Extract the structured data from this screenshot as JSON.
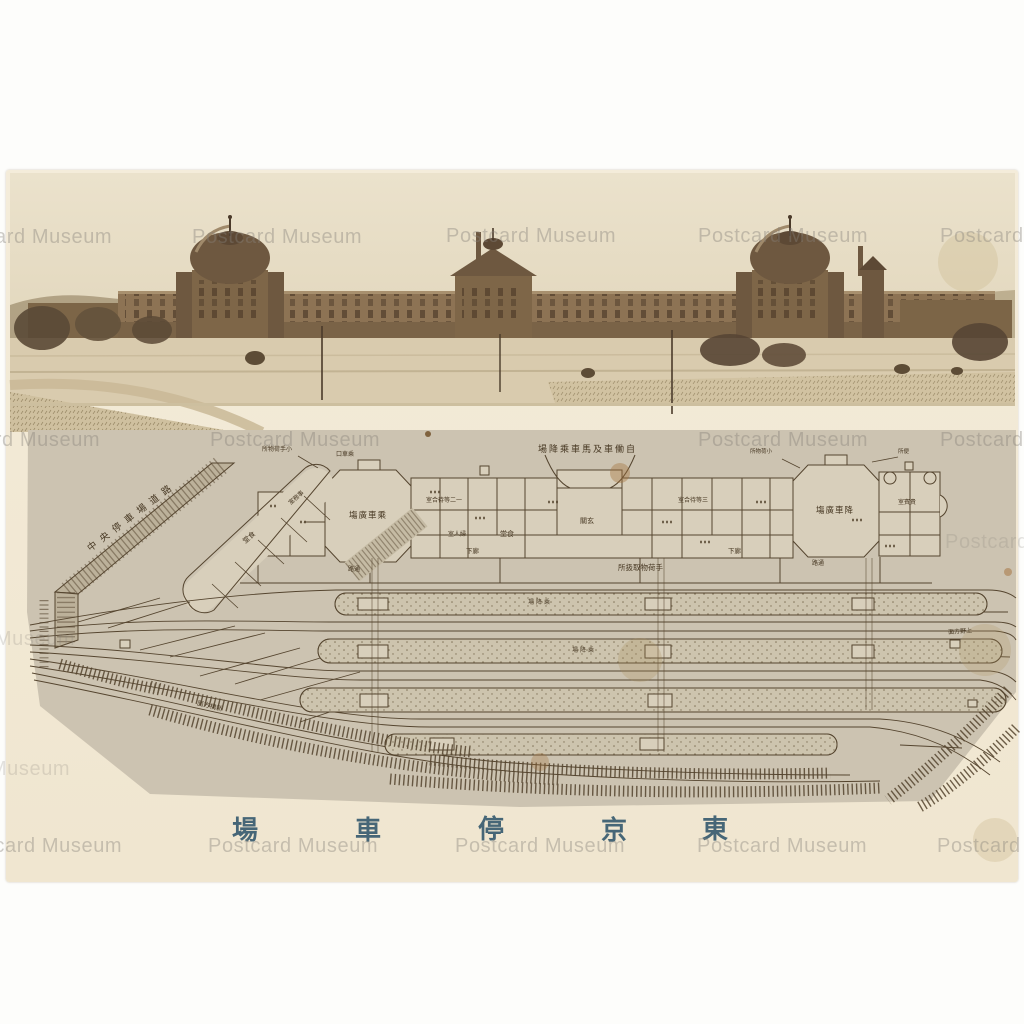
{
  "postcard": {
    "card_color": "#f2e9d5",
    "title": {
      "display_chars": [
        "場",
        "車",
        "停",
        "京",
        "東"
      ],
      "reads_right_to_left": "東京停車場",
      "color": "#2f556b"
    },
    "watermark": {
      "text": "Postcard Museum"
    },
    "photo": {
      "subject": "Tokyo Station brick facade with south and north domes, central pavilion, forecourt trees and plaza",
      "tone": "sepia"
    },
    "plan": {
      "paper_color": "#ccc3b1",
      "ink_color": "#55452f",
      "labels": [
        {
          "text": "中央停車場道路"
        },
        {
          "text": "場降乘車馬及車働自"
        },
        {
          "text": "塲廣車乘"
        },
        {
          "text": "塲廣車降"
        },
        {
          "text": "所扱取物荷手"
        },
        {
          "text": "室合待等二一"
        },
        {
          "text": "室人婦"
        },
        {
          "text": "堂食"
        },
        {
          "text": "關玄"
        },
        {
          "text": "室合待等三"
        },
        {
          "text": "下廊"
        },
        {
          "text": "下廊"
        },
        {
          "text": "室賓貴"
        },
        {
          "text": "所物荷手小"
        },
        {
          "text": "所物荷小"
        },
        {
          "text": "所便"
        },
        {
          "text": "口車乘"
        },
        {
          "text": "路通"
        },
        {
          "text": "路通"
        },
        {
          "text": "場降乘"
        },
        {
          "text": "場降乘"
        },
        {
          "text": "面方橋新"
        },
        {
          "text": "面方野上"
        },
        {
          "text": "堂食"
        },
        {
          "text": "室務事"
        }
      ]
    }
  }
}
